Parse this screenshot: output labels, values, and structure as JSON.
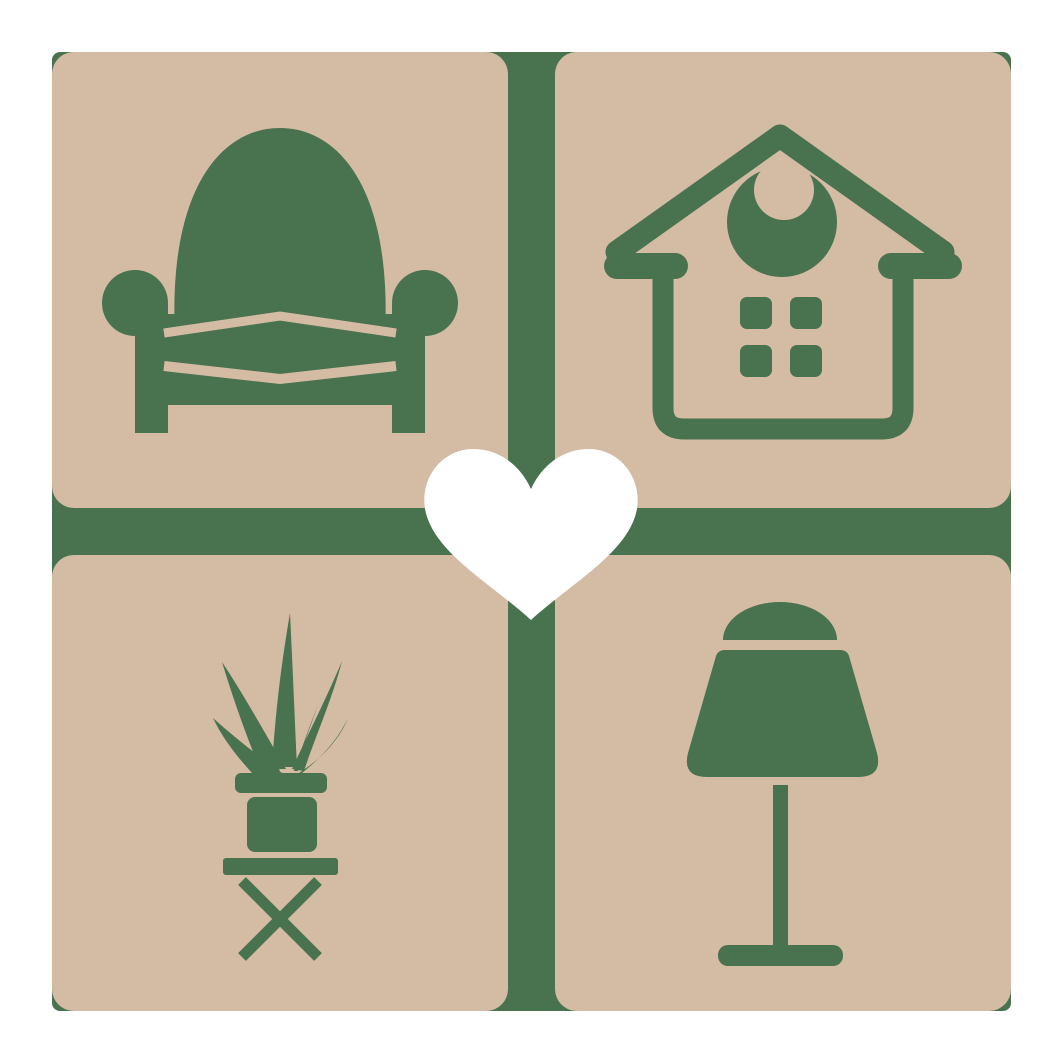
{
  "page": {
    "background": "#ffffff"
  },
  "logo": {
    "kind": "home-decor-furniture-logo",
    "colors": {
      "page": "#ffffff",
      "tile": "#d4bba4",
      "accent": "#49724f",
      "heart": "#ffffff"
    },
    "tiles": [
      {
        "position": "top-left",
        "icon": "armchair-icon"
      },
      {
        "position": "top-right",
        "icon": "house-icon"
      },
      {
        "position": "bottom-left",
        "icon": "potted-plant-icon"
      },
      {
        "position": "bottom-right",
        "icon": "table-lamp-icon"
      }
    ],
    "center_icon": "heart-icon"
  }
}
